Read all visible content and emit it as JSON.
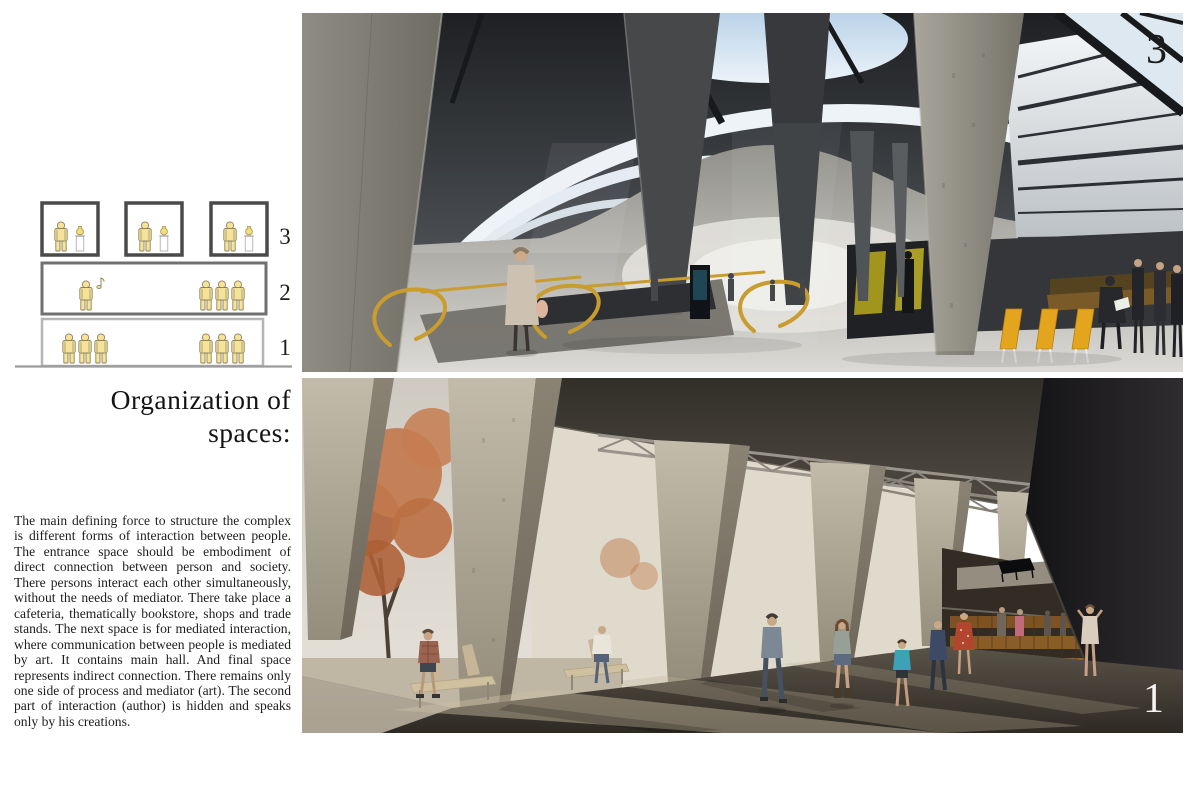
{
  "diagram": {
    "levels": [
      {
        "number": "3"
      },
      {
        "number": "2"
      },
      {
        "number": "1"
      }
    ],
    "icons": {
      "person": "person-icon",
      "artwork": "vase-icon",
      "music": "music-note-icon"
    },
    "palette": {
      "figure_yellow": "#f5e39a",
      "figure_outline": "#8f835f",
      "box_border_dark": "#4a4a4a",
      "box_border_mid": "#707070",
      "box_border_light": "#b5b5b5"
    }
  },
  "title": {
    "line1": "Organization of",
    "line2": "spaces:"
  },
  "paragraph": "The main defining force to structure the complex is different forms of interaction between people. The entrance space should be embodiment of direct connection between person and society. There persons interact each other simultaneously, without the needs of mediator. There take place a cafeteria, thematically bookstore, shops and trade stands. The next space is for mediated interaction, where communication between people is mediated by art. It contains main hall. And final space represents indirect connection. There remains only one side of process and mediator (art). The second part of interaction (author) is hidden and speaks only by his creations.",
  "figures": {
    "top": {
      "label": "3"
    },
    "bottom": {
      "label": "1"
    }
  },
  "palette": {
    "escalator_gold": "#c89c2e",
    "chair_amber": "#e3a41e",
    "foliage_orange": "#b2643c",
    "auditorium_seat_brown": "#96662e",
    "sky_blue": "#bcd6ec",
    "concrete": "#a39c8c",
    "top_label_color": "#1b1b1b",
    "bottom_label_color": "#f3f3f1"
  }
}
